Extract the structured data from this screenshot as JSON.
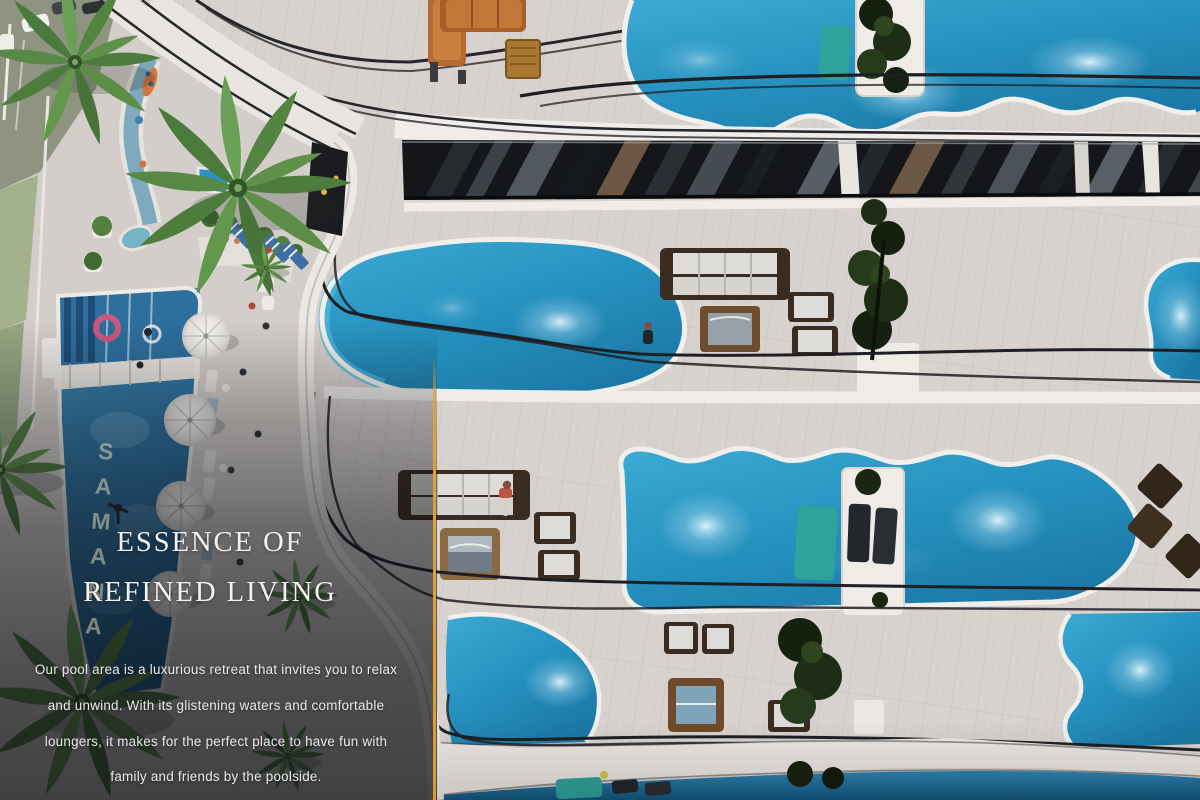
{
  "hero": {
    "heading_line1": "ESSENCE OF",
    "heading_line2": "REFINED LIVING",
    "paragraph_lines": [
      "Our pool area is a luxurious retreat that invites you to relax",
      "and unwind. With its glistening waters and comfortable",
      "loungers, it makes for the perfect place to have fun with",
      "family and friends by the poolside."
    ]
  },
  "scene": {
    "pool_floor_text": "SAMANA",
    "colors": {
      "accent_gold": "#E0A238",
      "pool_water": "#2B9CC9",
      "pool_deep": "#16587F",
      "deck": "#D8D2CF",
      "slab_white": "#EFECE9",
      "railing": "#1E1F23",
      "wood_furniture": "#6E4E2C",
      "leather_orange": "#B56A31",
      "teal_sunbed": "#2EA39A",
      "plant_dark": "#1C2A14",
      "foliage": "#4E7C3C",
      "lawn": "#9FB188",
      "street_olive": "#8E9480"
    }
  }
}
